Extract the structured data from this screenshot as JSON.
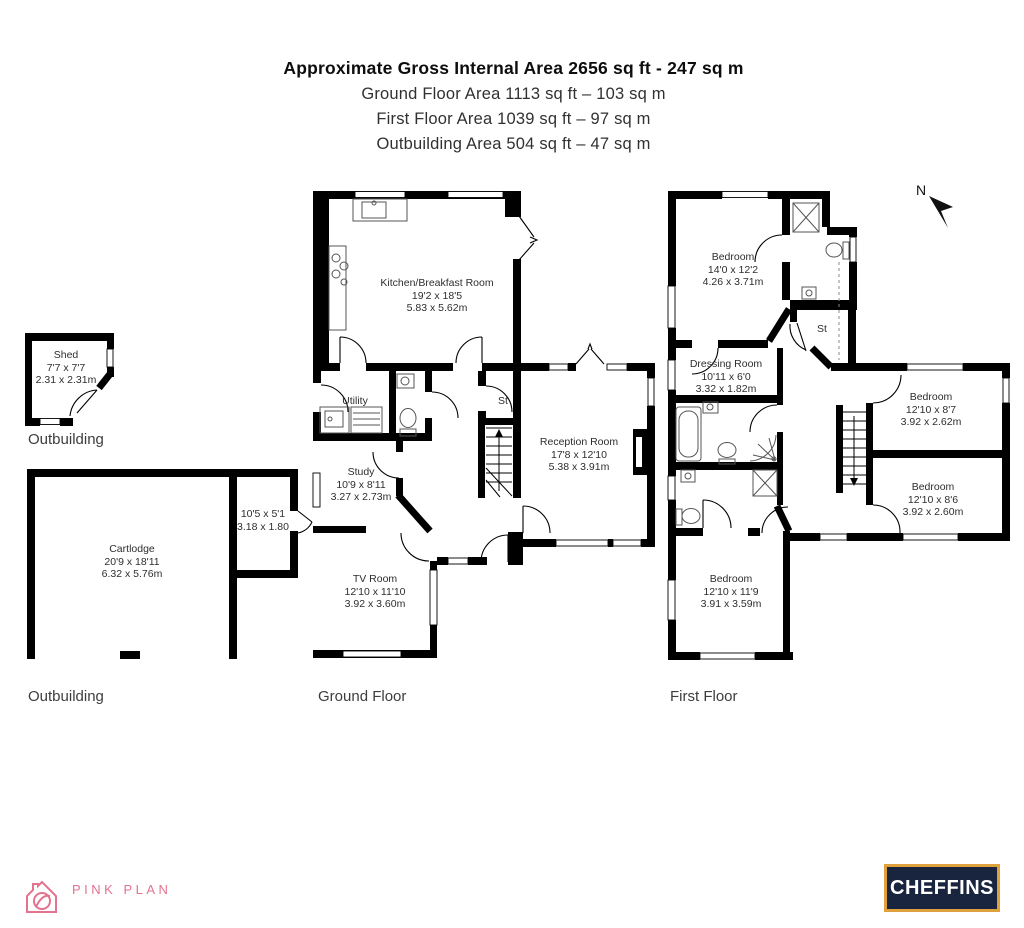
{
  "title": {
    "line1": "Approximate Gross Internal Area 2656 sq ft - 247 sq m",
    "line2": "Ground Floor Area 1113 sq ft – 103 sq m",
    "line3": "First Floor Area 1039 sq ft – 97 sq m",
    "line4": "Outbuilding Area 504 sq ft – 47 sq m"
  },
  "floor_labels": {
    "shed_outbuilding": "Outbuilding",
    "cartlodge_outbuilding": "Outbuilding",
    "ground": "Ground Floor",
    "first": "First Floor"
  },
  "compass": {
    "north_label": "N"
  },
  "rooms": {
    "shed": {
      "name": "Shed",
      "imperial": "7'7 x 7'7",
      "metric": "2.31 x 2.31m"
    },
    "cartlodge": {
      "name": "Cartlodge",
      "imperial": "20'9 x 18'11",
      "metric": "6.32 x 5.76m"
    },
    "cartlodge_store": {
      "imperial": "10'5 x 5'1",
      "metric": "3.18 x 1.80"
    },
    "kitchen": {
      "name": "Kitchen/Breakfast Room",
      "imperial": "19'2 x 18'5",
      "metric": "5.83 x 5.62m"
    },
    "utility": {
      "name": "Utility"
    },
    "store_ground": {
      "name": "St"
    },
    "study": {
      "name": "Study",
      "imperial": "10'9 x 8'11",
      "metric": "3.27 x 2.73m"
    },
    "tv_room": {
      "name": "TV Room",
      "imperial": "12'10 x 11'10",
      "metric": "3.92 x 3.60m"
    },
    "reception": {
      "name": "Reception Room",
      "imperial": "17'8 x 12'10",
      "metric": "5.38 x 3.91m"
    },
    "bedroom_1": {
      "name": "Bedroom",
      "imperial": "14'0 x 12'2",
      "metric": "4.26 x 3.71m"
    },
    "dressing": {
      "name": "Dressing Room",
      "imperial": "10'11 x 6'0",
      "metric": "3.32 x 1.82m"
    },
    "store_first": {
      "name": "St"
    },
    "bedroom_2": {
      "name": "Bedroom",
      "imperial": "12'10 x 8'7",
      "metric": "3.92 x 2.62m"
    },
    "bedroom_3": {
      "name": "Bedroom",
      "imperial": "12'10 x 8'6",
      "metric": "3.92 x 2.60m"
    },
    "bedroom_4": {
      "name": "Bedroom",
      "imperial": "12'10 x 11'9",
      "metric": "3.91 x 3.59m"
    }
  },
  "branding": {
    "pink_plan": {
      "text": "PINK PLAN",
      "color": "#e4738f"
    },
    "cheffins": {
      "text": "CHEFFINS",
      "background": "#19243e",
      "border": "#dfa13d",
      "text_color": "#ffffff"
    }
  }
}
